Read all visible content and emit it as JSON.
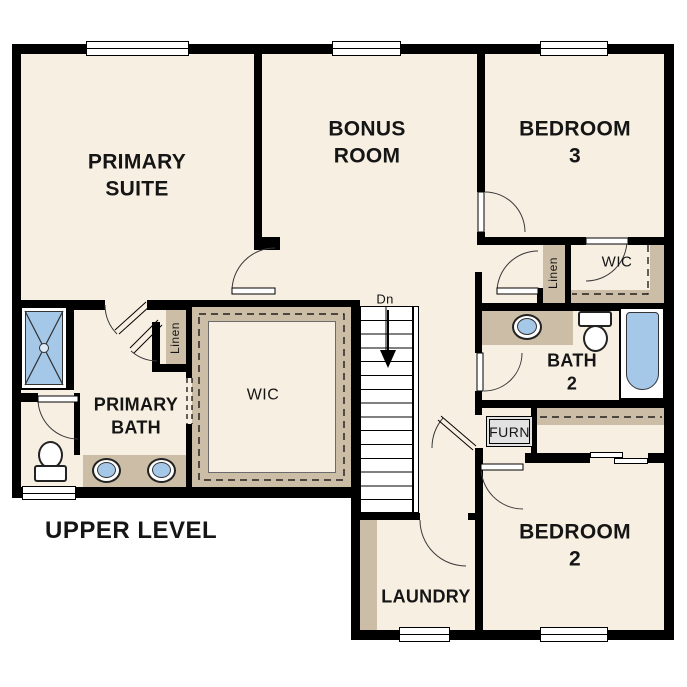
{
  "title": "UPPER LEVEL",
  "rooms": {
    "primary_suite": "PRIMARY\nSUITE",
    "bonus_room": "BONUS\nROOM",
    "bedroom_3": "BEDROOM 3",
    "bedroom_2": "BEDROOM 2",
    "primary_bath": "PRIMARY\nBATH",
    "bath_2": "BATH\n2",
    "laundry": "LAUNDRY",
    "primary_wic": "WIC",
    "bedroom3_wic": "WIC",
    "primary_linen": "Linen",
    "bedroom3_linen": "Linen",
    "furnace": "FURN",
    "stairs_down": "Dn"
  },
  "colors": {
    "wall": "#000000",
    "floor": "#f7efe2",
    "millwork": "#cbbda6",
    "fixture_blue": "#a5c8e9",
    "window": "#ffffff",
    "furnace_fill": "#e2e2e2"
  }
}
